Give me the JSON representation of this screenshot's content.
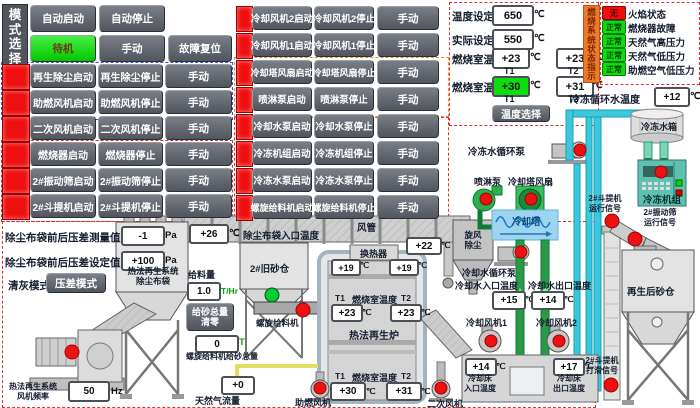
{
  "mode": {
    "title": "模式选择",
    "auto_start": "自动启动",
    "auto_stop": "自动停止",
    "standby": "待机",
    "manual": "手动",
    "fault_reset": "故障复位"
  },
  "left_controls": {
    "rows": [
      {
        "start": "再生除尘启动",
        "stop": "再生除尘停止",
        "manual": "手动"
      },
      {
        "start": "助燃风机启动",
        "stop": "助燃风机停止",
        "manual": "手动"
      },
      {
        "start": "二次风机启动",
        "stop": "二次风机停止",
        "manual": "手动"
      },
      {
        "start": "燃烧器启动",
        "stop": "燃烧器停止",
        "manual": "手动"
      },
      {
        "start": "2#振动筛启动",
        "stop": "2#振动筛停止",
        "manual": "手动"
      },
      {
        "start": "2#斗提机启动",
        "stop": "2#斗提机停止",
        "manual": "手动"
      }
    ]
  },
  "mid_controls": {
    "rows": [
      {
        "start": "冷却风机2启动",
        "stop": "冷却风机2停止",
        "manual": "手动"
      },
      {
        "start": "冷却风机1启动",
        "stop": "冷却风机1停止",
        "manual": "手动"
      },
      {
        "start": "冷却塔风扇启动",
        "stop": "冷却塔风扇停止",
        "manual": "手动"
      },
      {
        "start": "喷淋泵启动",
        "stop": "喷淋泵停止",
        "manual": "手动"
      },
      {
        "start": "冷却水泵启动",
        "stop": "冷却水泵停止",
        "manual": "手动"
      },
      {
        "start": "冷冻机组启动",
        "stop": "冷冻机组停止",
        "manual": "手动"
      },
      {
        "start": "冷冻水泵启动",
        "stop": "冷冻水泵停止",
        "manual": "手动"
      },
      {
        "start": "螺旋给料机启动",
        "stop": "螺旋给料机停止",
        "manual": "手动"
      }
    ]
  },
  "temp_panel": {
    "set_label": "温度设定值",
    "set_value": "650",
    "actual_label": "实际设定值",
    "actual_value": "550",
    "chamber1_label": "燃烧室温度",
    "chamber1_t1": "+23",
    "chamber1_t2": "+23",
    "chamber2_label": "燃烧室温度",
    "chamber2_t1": "+30",
    "chamber2_t2": "+31",
    "t1": "T1",
    "t2": "T2",
    "select_button": "温度选择"
  },
  "burner_status": {
    "title": "燃烧系统状态指示",
    "rows": [
      {
        "state": "无",
        "label": "火焰状态"
      },
      {
        "state": "正常",
        "label": "燃烧器故障"
      },
      {
        "state": "正常",
        "label": "天然气高压力"
      },
      {
        "state": "正常",
        "label": "天然气低压力"
      },
      {
        "state": "正常",
        "label": "助燃空气低压力"
      }
    ]
  },
  "chilled_water": {
    "label": "冷冻循环水温度",
    "value": "+12"
  },
  "units": {
    "c": "℃",
    "pa": "Pa",
    "hz": "Hz",
    "thr": "T/Hr",
    "t": "T"
  },
  "colors": {
    "accent_red": "#ee0f0f",
    "accent_green": "#0ddd0d",
    "pipe_cyan": "#3cc8dc",
    "pipe_green": "#2a9a4a",
    "status_orange": "#ed7a2a"
  },
  "diagram": {
    "dp_meas_label": "除尘布袋前后压差测量值",
    "dp_meas_value": "-1",
    "dp_set_label": "除尘布袋前后压差设定值",
    "dp_set_value": "+100",
    "clean_mode_label": "清灰模式",
    "clean_mode_button": "压差模式",
    "baghouse_label": "热法再生系统\n除尘布袋",
    "fan_freq_label": "热法再生系统\n风机频率",
    "fan_freq_value": "50",
    "inlet_temp_value": "+26",
    "inlet_temp_label": "除尘布袋入口温度",
    "duct_label": "风管",
    "duct_temp_value": "+22",
    "cyclone_label": "旋风\n除尘",
    "old_bin_label": "2#旧砂仓",
    "feed_label": "给料量",
    "feed_value": "1.0",
    "reset_button": "给砂总量\n清零",
    "screw_total_value": "0",
    "screw_total_label": "螺旋给料机给砂总量",
    "screw_label": "螺旋给料机",
    "gas_value": "+0",
    "gas_label": "天然气流量",
    "comb_fan_label": "助燃风机",
    "sec_fan_label": "二次风机",
    "hx_label": "换热器",
    "hx_t1": "+19",
    "hx_t2": "+19",
    "chamber_label": "燃烧室温度",
    "t1": "T1",
    "t2": "T2",
    "cu_t1": "+23",
    "cu_t2": "+23",
    "cl_t1": "+30",
    "cl_t2": "+31",
    "furnace_label": "热法再生炉",
    "chilled_pump_label": "冷冻水循环泵",
    "spray_pump_label": "喷淋泵",
    "tower_fan_label": "冷却塔风扇",
    "tower_label": "冷却塔",
    "cooling_pump_label": "冷却水循环泵",
    "cw_in_label": "冷却水入口温度",
    "cw_in_value": "+15",
    "cw_out_label": "冷却水出口温度",
    "cw_out_value": "+14",
    "fan1_label": "冷却风机1",
    "fan2_label": "冷却风机2",
    "bed_in_value": "+14",
    "bed_in_label": "冷却床\n入口温度",
    "bed_out_value": "+17",
    "bed_out_label": "冷却床\n出口温度",
    "tank_label": "冷冻水箱",
    "chiller_label": "冷冻机组",
    "elev_run_label": "2#斗提机\n运行信号",
    "screen_run_label": "2#振动筛\n运行信号",
    "regen_bin_label": "再生后砂仓",
    "slip_label": "2#斗提机\n打滑信号"
  }
}
